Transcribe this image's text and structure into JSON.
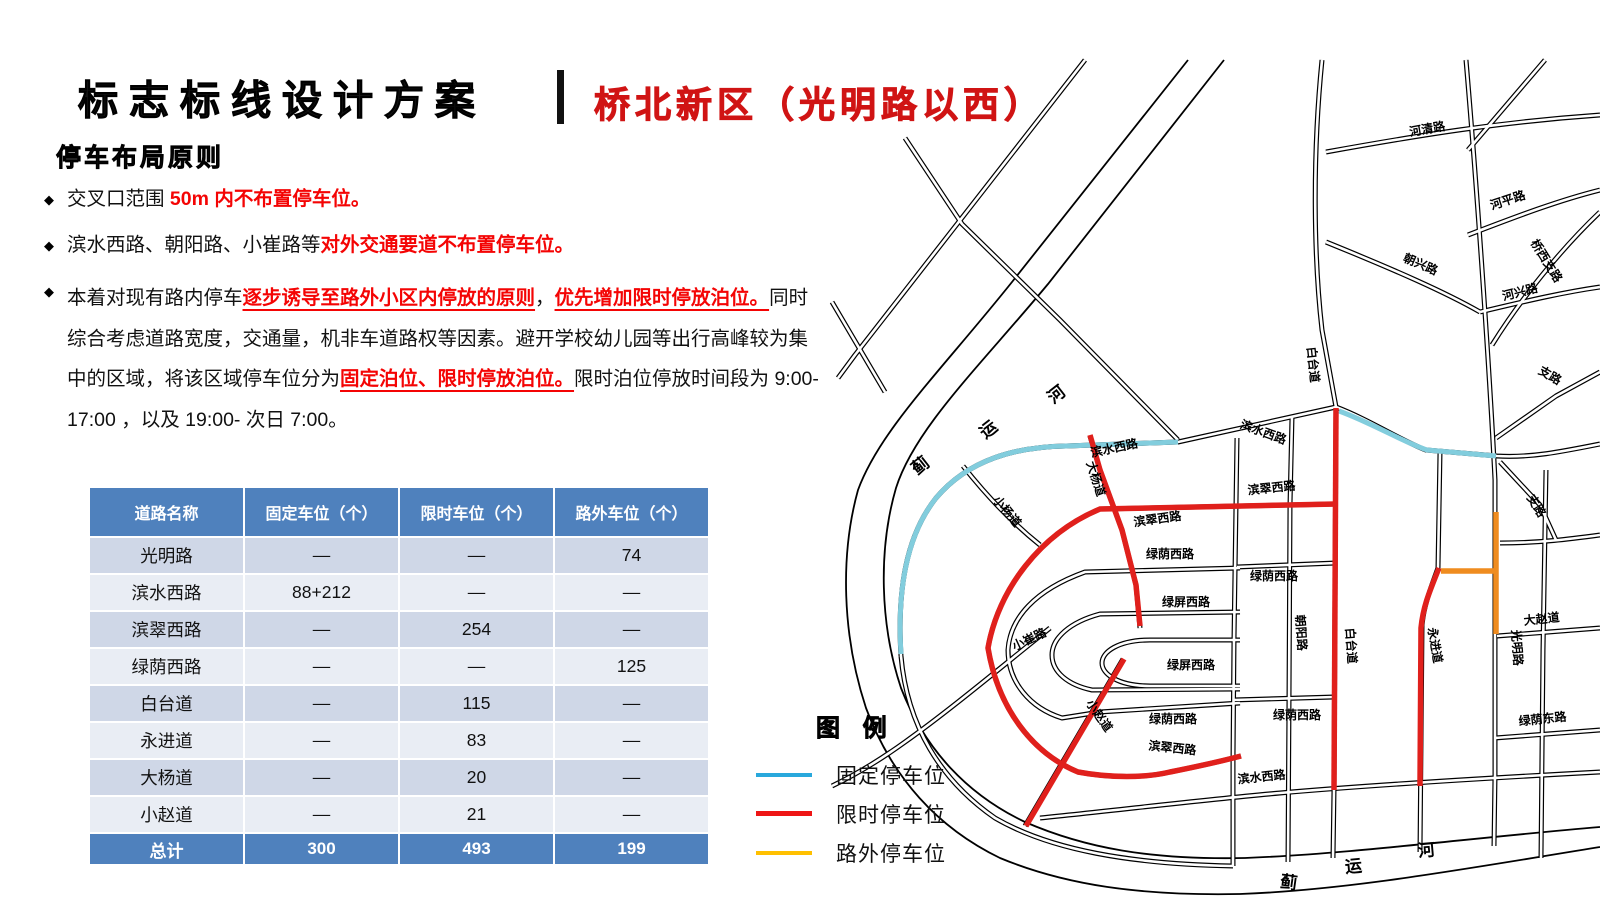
{
  "title": {
    "main": "标志标线设计方案",
    "sub": "桥北新区（光明路以西）"
  },
  "section_heading": "停车布局原则",
  "bullets": [
    {
      "wide": false,
      "segments": [
        {
          "t": "交叉口范围 ",
          "s": "b"
        },
        {
          "t": "50m ",
          "s": "r"
        },
        {
          "t": "内不布置停车位。",
          "s": "r"
        }
      ]
    },
    {
      "wide": false,
      "segments": [
        {
          "t": "滨水西路、朝阳路、小崔路等",
          "s": "b"
        },
        {
          "t": "对外交通要道不布置停车位。",
          "s": "r"
        }
      ]
    },
    {
      "wide": true,
      "segments": [
        {
          "t": "本着对现有路内停车",
          "s": "b"
        },
        {
          "t": "逐步诱导至路外小区内停放的原则",
          "s": "ru"
        },
        {
          "t": "，",
          "s": "b"
        },
        {
          "t": "优先增加限时停放泊位。",
          "s": "ru"
        },
        {
          "t": "同时综合考虑道路宽度，交通量，机非车道路权等因素。避开学校幼儿园等出行高峰较为集中的区域，将该区域停车位分为",
          "s": "b"
        },
        {
          "t": "固定泊位、限时停放泊位。",
          "s": "ru"
        },
        {
          "t": "限时泊位停放时间段为 9:00-17:00 ，以及 19:00- 次日 7:00。",
          "s": "b"
        }
      ]
    }
  ],
  "table": {
    "headers": [
      "道路名称",
      "固定车位（个）",
      "限时车位（个）",
      "路外车位（个）"
    ],
    "rows": [
      [
        "光明路",
        "—",
        "—",
        "74"
      ],
      [
        "滨水西路",
        "88+212",
        "—",
        "—"
      ],
      [
        "滨翠西路",
        "—",
        "254",
        "—"
      ],
      [
        "绿荫西路",
        "—",
        "—",
        "125"
      ],
      [
        "白台道",
        "—",
        "115",
        "—"
      ],
      [
        "永进道",
        "—",
        "83",
        "—"
      ],
      [
        "大杨道",
        "—",
        "20",
        "—"
      ],
      [
        "小赵道",
        "—",
        "21",
        "—"
      ]
    ],
    "total_row": [
      "总计",
      "300",
      "493",
      "199"
    ]
  },
  "legend": {
    "title": "图 例",
    "items": [
      {
        "label": "固定停车位",
        "color": "#29a8dc",
        "thick": 4
      },
      {
        "label": "限时停车位",
        "color": "#ee1515",
        "thick": 5
      },
      {
        "label": "路外停车位",
        "color": "#ffc000",
        "thick": 4
      }
    ]
  },
  "map": {
    "colors": {
      "fixed": "#82cddd",
      "timed": "#e0201c",
      "offstreet": "#ef8c1f"
    },
    "road_labels": [
      {
        "text": "河清路",
        "x": 1428,
        "y": 133,
        "r": -10,
        "size": 12
      },
      {
        "text": "河平路",
        "x": 1509,
        "y": 204,
        "r": -18,
        "size": 12
      },
      {
        "text": "桥西支路",
        "x": 1543,
        "y": 263,
        "r": 58,
        "size": 12
      },
      {
        "text": "朝兴路",
        "x": 1419,
        "y": 268,
        "r": 23,
        "size": 12
      },
      {
        "text": "河兴路",
        "x": 1521,
        "y": 296,
        "r": -14,
        "size": 12
      },
      {
        "text": "支路",
        "x": 1548,
        "y": 379,
        "r": 30,
        "size": 12
      },
      {
        "text": "支路",
        "x": 1533,
        "y": 508,
        "r": 58,
        "size": 12
      },
      {
        "text": "白台道",
        "x": 1309,
        "y": 365,
        "r": 84,
        "size": 12
      },
      {
        "text": "白台道",
        "x": 1347,
        "y": 646,
        "r": 86,
        "size": 12
      },
      {
        "text": "光明路",
        "x": 1513,
        "y": 648,
        "r": 86,
        "size": 12
      },
      {
        "text": "永进道",
        "x": 1431,
        "y": 646,
        "r": 80,
        "size": 12
      },
      {
        "text": "朝阳路",
        "x": 1297,
        "y": 633,
        "r": 86,
        "size": 12
      },
      {
        "text": "滨水西路",
        "x": 1115,
        "y": 452,
        "r": -12,
        "size": 12
      },
      {
        "text": "滨水西路",
        "x": 1262,
        "y": 436,
        "r": 20,
        "size": 12
      },
      {
        "text": "滨水西路",
        "x": 1262,
        "y": 781,
        "r": -6,
        "size": 12
      },
      {
        "text": "滨翠西路",
        "x": 1272,
        "y": 492,
        "r": -6,
        "size": 12
      },
      {
        "text": "滨翠西路",
        "x": 1158,
        "y": 523,
        "r": -8,
        "size": 12
      },
      {
        "text": "滨翠西路",
        "x": 1172,
        "y": 752,
        "r": 6,
        "size": 12
      },
      {
        "text": "绿荫西路",
        "x": 1170,
        "y": 558,
        "r": 0,
        "size": 12
      },
      {
        "text": "绿荫西路",
        "x": 1274,
        "y": 580,
        "r": 0,
        "size": 12
      },
      {
        "text": "绿荫西路",
        "x": 1173,
        "y": 723,
        "r": 0,
        "size": 12
      },
      {
        "text": "绿荫西路",
        "x": 1297,
        "y": 719,
        "r": 0,
        "size": 12
      },
      {
        "text": "绿屏西路",
        "x": 1186,
        "y": 606,
        "r": 0,
        "size": 12
      },
      {
        "text": "绿屏西路",
        "x": 1191,
        "y": 669,
        "r": 0,
        "size": 12
      },
      {
        "text": "大杨道",
        "x": 1092,
        "y": 480,
        "r": 72,
        "size": 12
      },
      {
        "text": "小杨道",
        "x": 1004,
        "y": 514,
        "r": 50,
        "size": 12
      },
      {
        "text": "小赵道",
        "x": 1096,
        "y": 718,
        "r": 55,
        "size": 12
      },
      {
        "text": "小崔路",
        "x": 1031,
        "y": 643,
        "r": -25,
        "size": 12
      },
      {
        "text": "大赵道",
        "x": 1542,
        "y": 623,
        "r": -6,
        "size": 12
      },
      {
        "text": "绿荫东路",
        "x": 1543,
        "y": 723,
        "r": -6,
        "size": 12
      }
    ],
    "river_labels": [
      {
        "text": "蓟",
        "x": 924,
        "y": 470,
        "r": -38,
        "size": 17
      },
      {
        "text": "运",
        "x": 992,
        "y": 434,
        "r": -38,
        "size": 17
      },
      {
        "text": "河",
        "x": 1060,
        "y": 399,
        "r": -38,
        "size": 17
      },
      {
        "text": "蓟",
        "x": 1288,
        "y": 888,
        "r": 8,
        "size": 17
      },
      {
        "text": "运",
        "x": 1354,
        "y": 872,
        "r": -5,
        "size": 17
      },
      {
        "text": "河",
        "x": 1427,
        "y": 856,
        "r": -5,
        "size": 17
      }
    ]
  }
}
